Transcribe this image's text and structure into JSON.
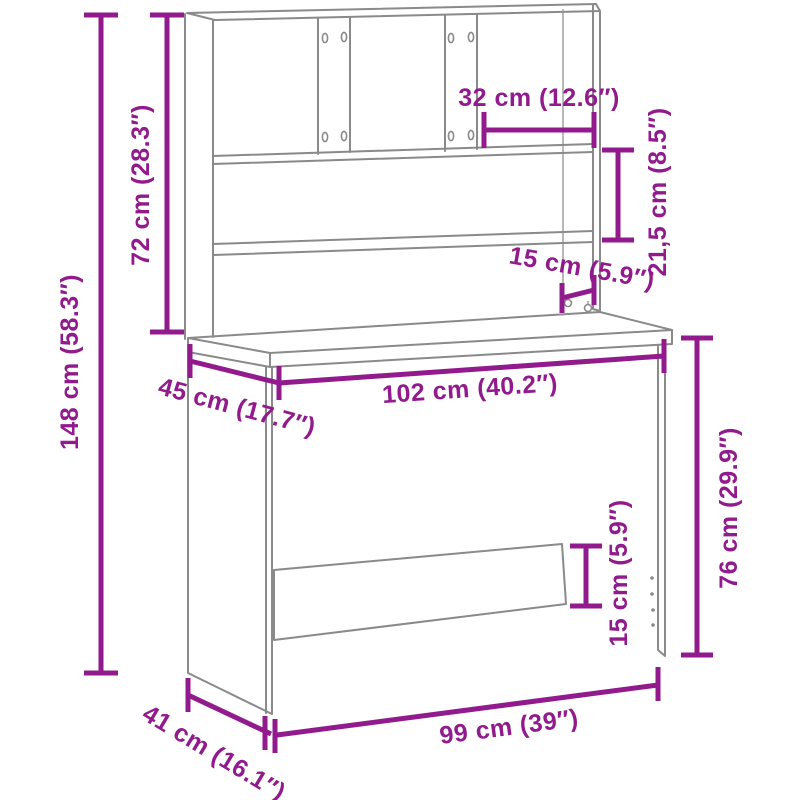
{
  "diagram": {
    "type": "furniture-dimension-diagram",
    "subject": "desk-with-hutch",
    "style": {
      "dimension_color": "#911b8c",
      "outline_color": "#8a8a8a",
      "background": "#ffffff"
    },
    "labels": {
      "total_height": "148 cm (58.3″)",
      "hutch_height": "72 cm (28.3″)",
      "compartment_width": "32 cm (12.6″)",
      "shelf_spacing": "21,5 cm (8.5″)",
      "support_spacing": "15 cm (5.9″)",
      "desktop_depth": "45 cm (17.7″)",
      "desktop_width": "102 cm (40.2″)",
      "desk_height": "76 cm (29.9″)",
      "crossbar_height": "15 cm (5.9″)",
      "base_width": "99 cm (39″)",
      "base_depth": "41 cm (16.1″)"
    }
  }
}
